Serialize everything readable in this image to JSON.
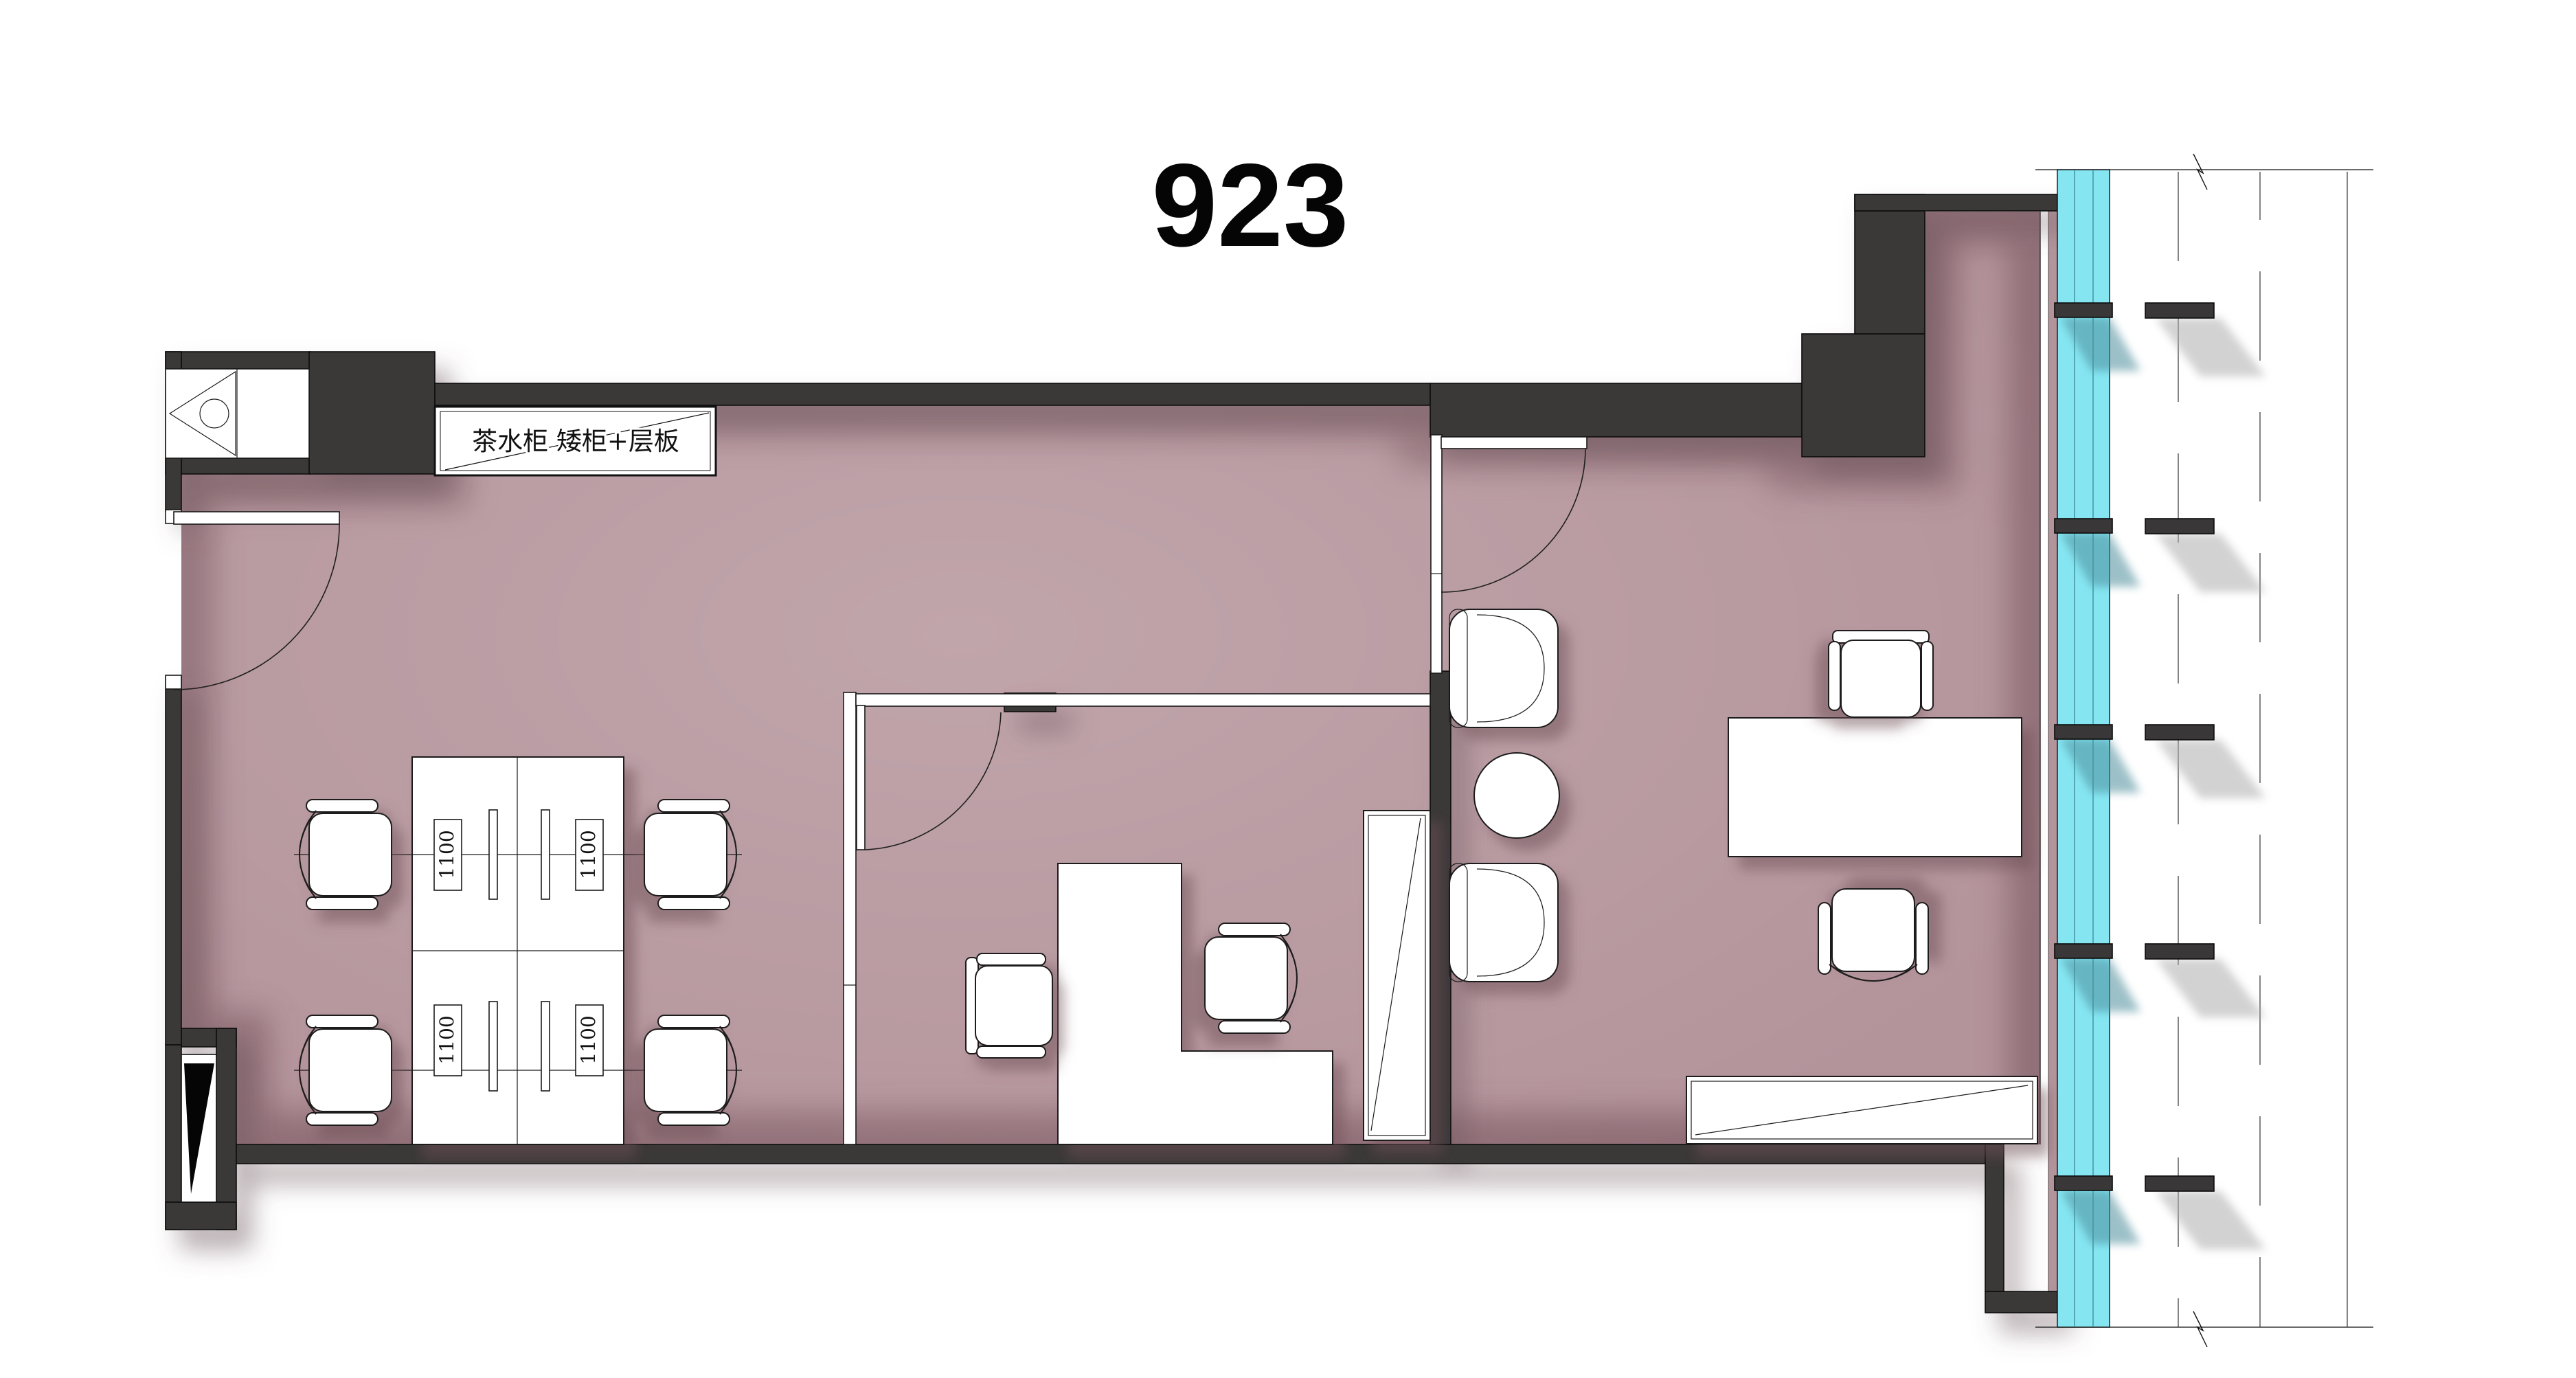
{
  "title": "923",
  "annotations": {
    "cabinet_label": "茶水柜 矮柜+层板",
    "desk_width_label": "1100"
  },
  "colors": {
    "wall": "#3a3738",
    "floor": "#b4949b",
    "glazing": "#85e6f2",
    "glazing_line": "#35808d",
    "outline": "#1a1a1a",
    "paper": "#ffffff",
    "shadow": "#6b565b"
  }
}
